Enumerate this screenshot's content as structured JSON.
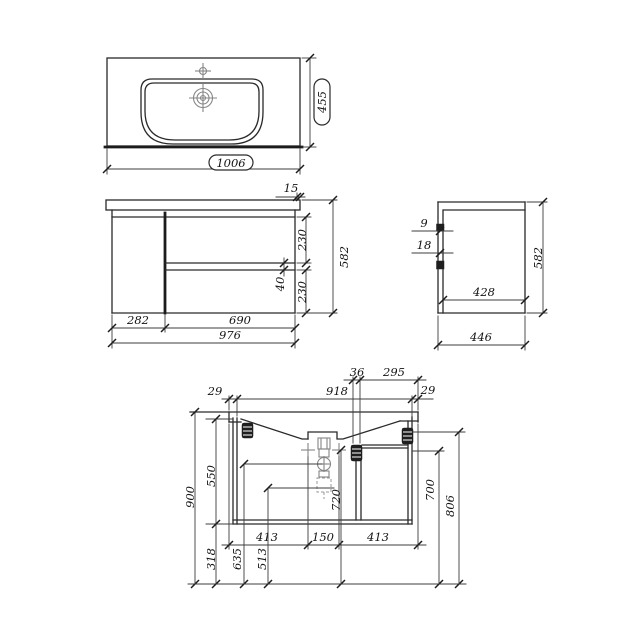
{
  "drawing": {
    "type": "furniture technical drawing - wall-hung vanity unit with washbasin",
    "colors": {
      "background": "#ffffff",
      "line": "#2a2a2a",
      "plumbing_detail": "#868686"
    },
    "views": {
      "top": {
        "basin_width": "1006",
        "basin_depth": "455"
      },
      "front": {
        "countertop_overhang": "15",
        "upper_drawer_height": "230",
        "drawer_gap": "40",
        "lower_drawer_height": "230",
        "total_height": "582",
        "door_width": "282",
        "drawer_width": "690",
        "cabinet_width": "976"
      },
      "side": {
        "front_reveal": "9",
        "front_panel_thickness": "18",
        "body_depth": "428",
        "total_height": "582",
        "total_depth": "446"
      },
      "section": {
        "overhang_left": "29",
        "inner_width": "918",
        "overhang_right": "29",
        "bracket_width": "36",
        "bracket_to_edge": "295",
        "worktop_height": "900",
        "body_span": "550",
        "floor_clearance": "318",
        "valve_height": "635",
        "outlet_height": "513",
        "mount_hole_height": "720",
        "shelf_height": "700",
        "bracket_height": "806",
        "hole_offset_left": "413",
        "hole_spacing": "150",
        "hole_offset_right": "413"
      }
    }
  }
}
